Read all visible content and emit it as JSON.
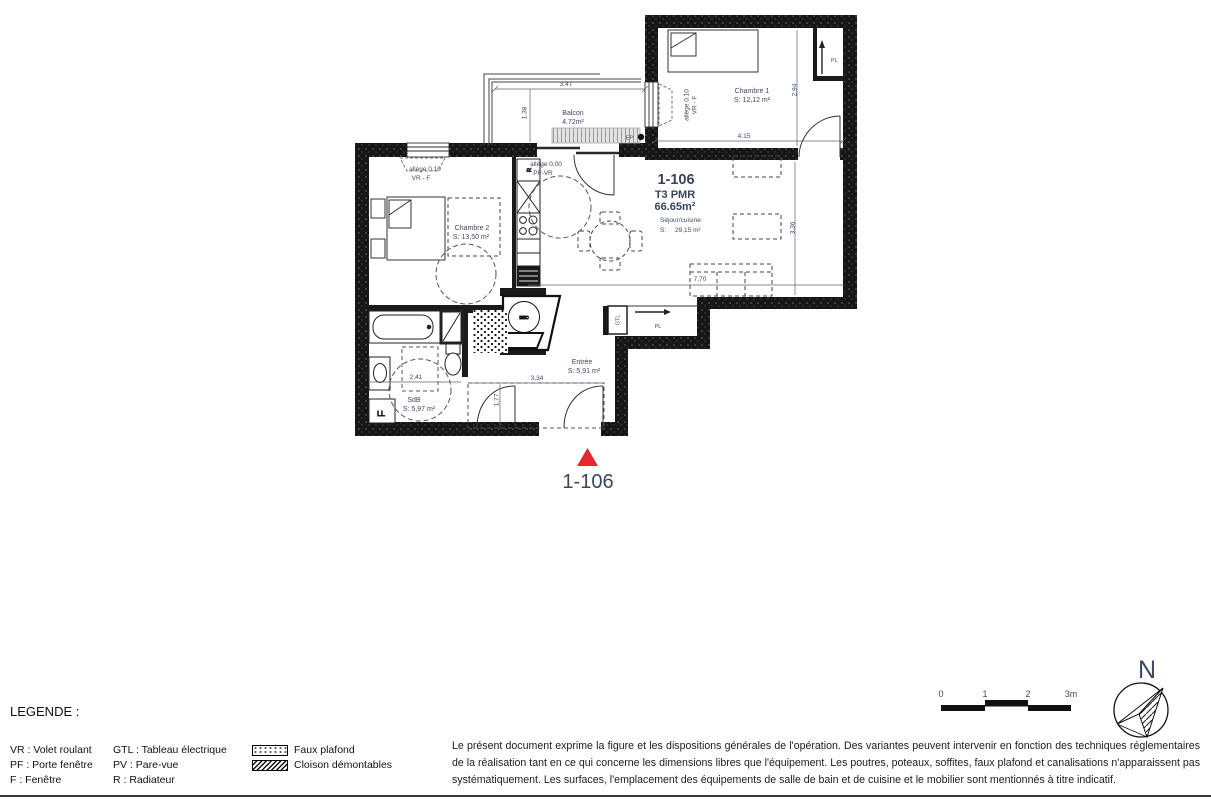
{
  "plan": {
    "unit": {
      "id": "1-106",
      "type": "T3 PMR",
      "area": "66.65m²",
      "room": "Séjour/cuisine",
      "area_prefix": "S:",
      "room_area": "29,15 m²"
    },
    "rooms": {
      "chambre1": {
        "name": "Chambre 1",
        "area": "S: 12,12 m²"
      },
      "chambre2": {
        "name": "Chambre 2",
        "area": "S: 13,50 m²"
      },
      "balcon": {
        "name": "Balcon",
        "area": "4.72m²"
      },
      "entree": {
        "name": "Entrée",
        "area": "S: 5,91 m²"
      },
      "sdb": {
        "name": "SdB",
        "area": "S: 5,97 m²"
      }
    },
    "dims": {
      "balcon_w": "3.47",
      "balcon_d": "1.38",
      "ch1_w": "4.15",
      "ch1_d": "2,94",
      "sejour_w": "7,70",
      "sejour_d": "3,36",
      "sdb_w": "2,41",
      "entree_w": "3,34",
      "entree_d": "1,77"
    },
    "notes": {
      "allege1a": "allège 0.10",
      "allege1b": "VR - F",
      "allege2a": "allège 0,00",
      "allege2b": "PF-VR",
      "allege3a": "allège 0.10",
      "allege3b": "VR - F",
      "ep": "EP",
      "radiator": "R",
      "gtl": "GTL",
      "pl_entry": "PL",
      "pl_ch1": "PL",
      "ll": "LL",
      "bec": "BEC"
    }
  },
  "marker": {
    "label": "1-106",
    "triangle_color": "#e8282e"
  },
  "legend": {
    "title": "LEGENDE :",
    "col1": [
      "VR : Volet roulant",
      "PF : Porte fenêtre",
      "F : Fenêtre"
    ],
    "col2": [
      "GTL : Tableau électrique",
      "PV : Pare-vue",
      "R : Radiateur"
    ],
    "patterns": [
      {
        "swatch": "dots",
        "label": "Faux plafond"
      },
      {
        "swatch": "hatch",
        "label": "Cloison démontables"
      }
    ]
  },
  "scalebar": {
    "labels": [
      "0",
      "1",
      "2",
      "3m"
    ]
  },
  "north": {
    "label": "N"
  },
  "disclaimer": {
    "text": "Le présent document exprime la figure et les dispositions générales de l'opération. Des variantes peuvent intervenir en fonction des techniques réglementaires de la réalisation tant en ce qui concerne les dimensions libres que l'équipement. Les poutres, poteaux, soffites, faux plafond et canalisations n'apparaissent pas systématiquement. Les surfaces, l'emplacement des équipements de salle de bain et de cuisine et le mobilier sont mentionnés à titre indicatif."
  }
}
